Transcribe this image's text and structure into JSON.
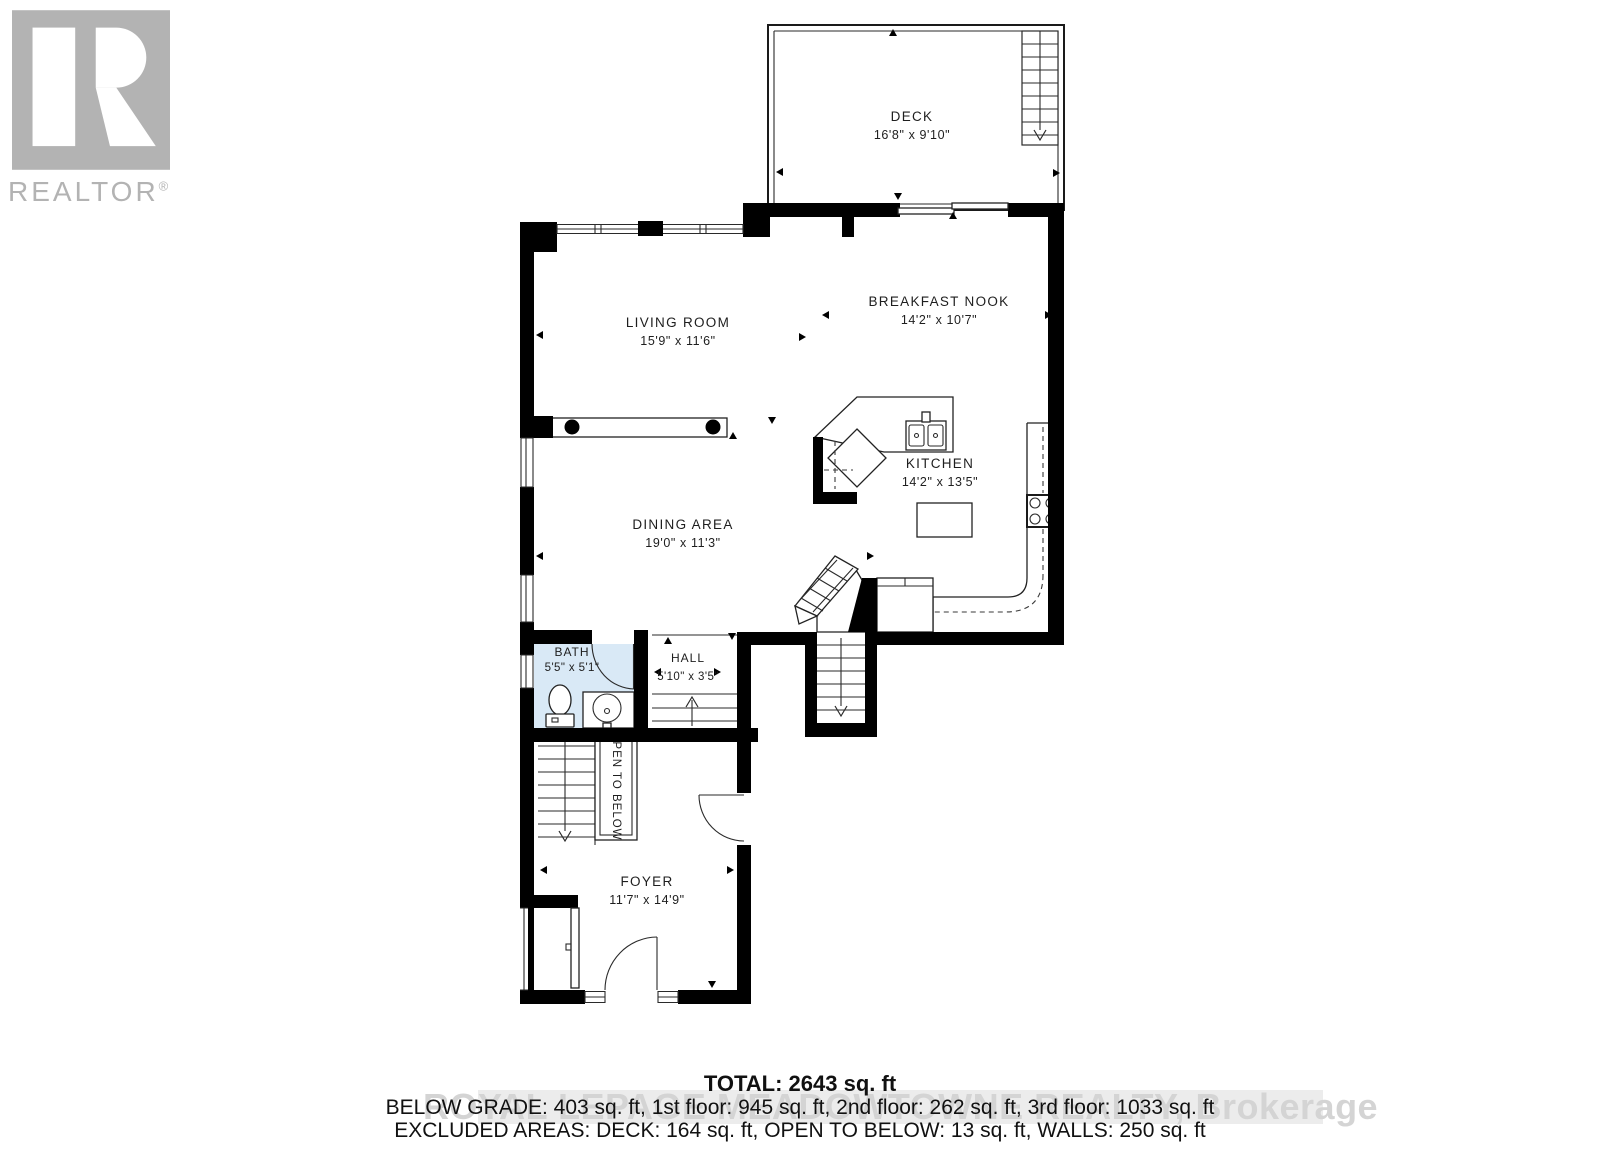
{
  "logo": {
    "realtor_label": "REALTOR",
    "registered_mark": "®"
  },
  "rooms": {
    "deck": {
      "name": "DECK",
      "dims": "16'8\" x 9'10\""
    },
    "living": {
      "name": "LIVING ROOM",
      "dims": "15'9\" x 11'6\""
    },
    "nook": {
      "name": "BREAKFAST NOOK",
      "dims": "14'2\" x 10'7\""
    },
    "kitchen": {
      "name": "KITCHEN",
      "dims": "14'2\" x 13'5\""
    },
    "dining": {
      "name": "DINING AREA",
      "dims": "19'0\" x 11'3\""
    },
    "bath": {
      "name": "BATH",
      "dims": "5'5\" x 5'1\""
    },
    "hall": {
      "name": "HALL",
      "dims": "5'10\" x 3'5\""
    },
    "foyer": {
      "name": "FOYER",
      "dims": "11'7\" x 14'9\""
    },
    "open_to_below": {
      "name": "OPEN TO BELOW"
    }
  },
  "summary": {
    "total": "TOTAL: 2643 sq. ft",
    "line2": "BELOW GRADE: 403 sq. ft, 1st floor: 945 sq. ft, 2nd floor: 262 sq. ft, 3rd floor: 1033 sq. ft",
    "line3": "EXCLUDED AREAS: DECK: 164 sq. ft, OPEN TO BELOW: 13 sq. ft, WALLS: 250 sq. ft"
  },
  "watermark": "ROYAL LEPAGE MEADOWTOWNE REALTY, Brokerage",
  "colors": {
    "wall": "#000000",
    "bath_fill": "#d9e9f6",
    "logo_gray": "#b3b3b3",
    "watermark_band": "#ececec",
    "watermark_text": "#d4d4d4"
  }
}
